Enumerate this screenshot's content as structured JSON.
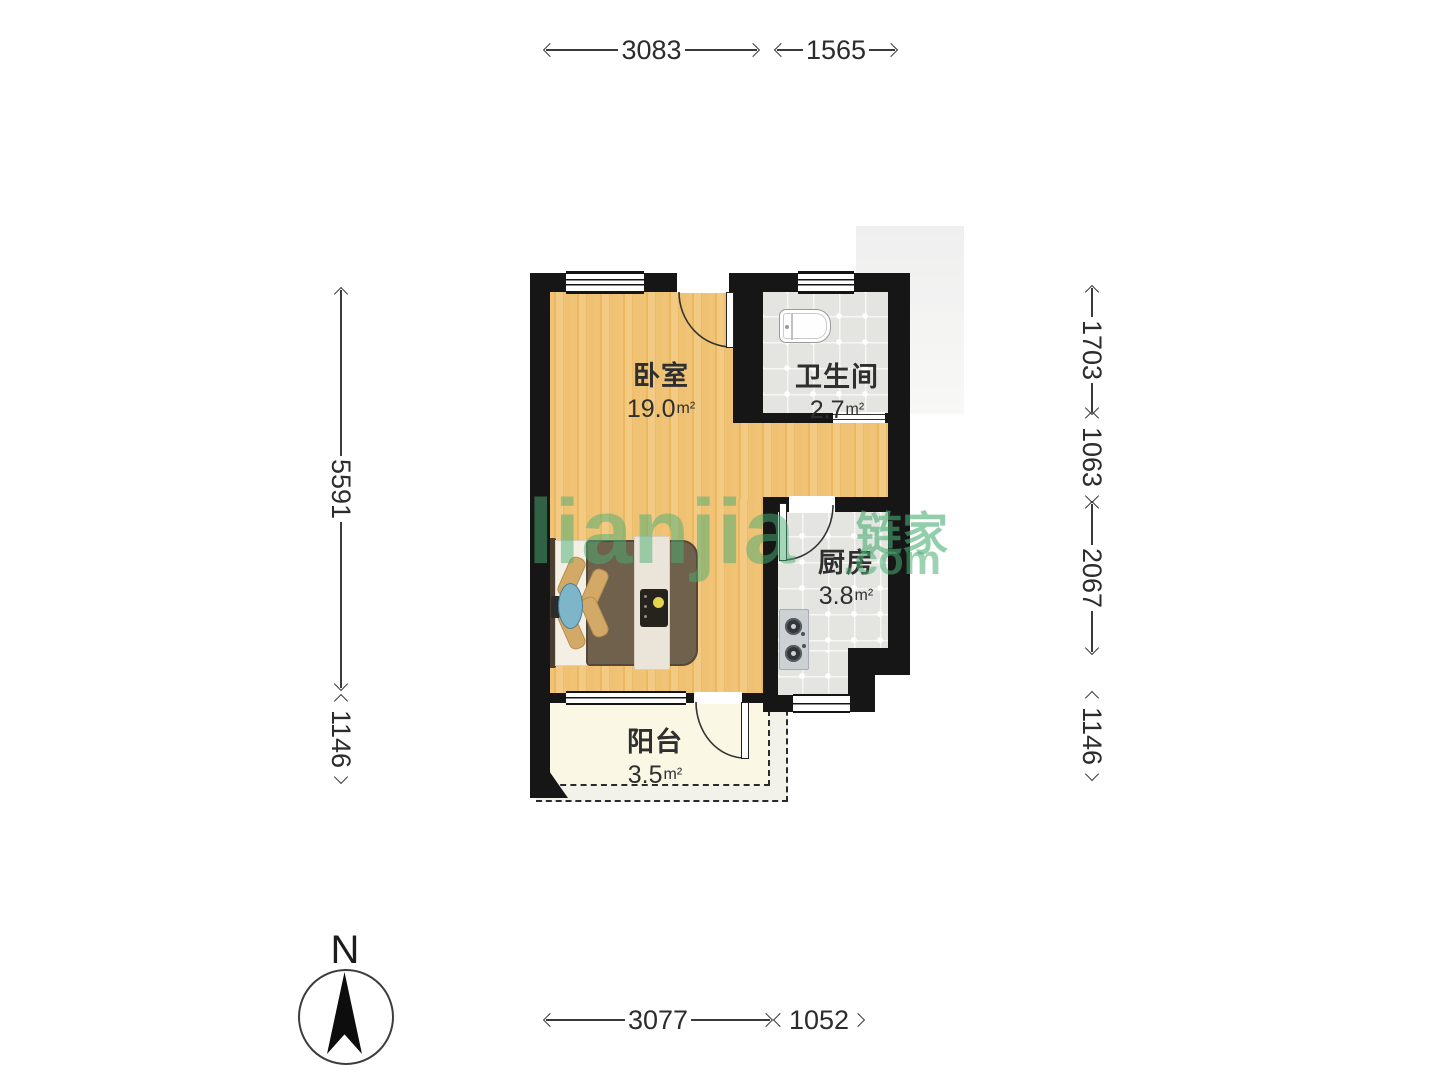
{
  "rooms": {
    "bedroom": {
      "name": "卧室",
      "area": "19.0",
      "area_unit": "m²"
    },
    "bathroom": {
      "name": "卫生间",
      "area": "2.7",
      "area_unit": "m²"
    },
    "kitchen": {
      "name": "厨房",
      "area": "3.8",
      "area_unit": "m²"
    },
    "balcony": {
      "name": "阳台",
      "area": "3.5",
      "area_unit": "m²"
    }
  },
  "dimensions_mm": {
    "top": [
      "3083",
      "1565"
    ],
    "bottom": [
      "3077",
      "1052"
    ],
    "left": [
      "5591",
      "1146"
    ],
    "right": [
      "1703",
      "1063",
      "2067",
      "1146"
    ]
  },
  "compass": {
    "north_label": "N"
  },
  "watermark": {
    "brand": "Lianjia",
    "brand_cjk": "链家",
    "brand_tld": ".com",
    "color": "#49ae73"
  },
  "colors": {
    "wall": "#161616",
    "wood_floor": "#efc172",
    "tile_floor": "#e4e4e1",
    "balcony_floor": "#faf7e4"
  }
}
